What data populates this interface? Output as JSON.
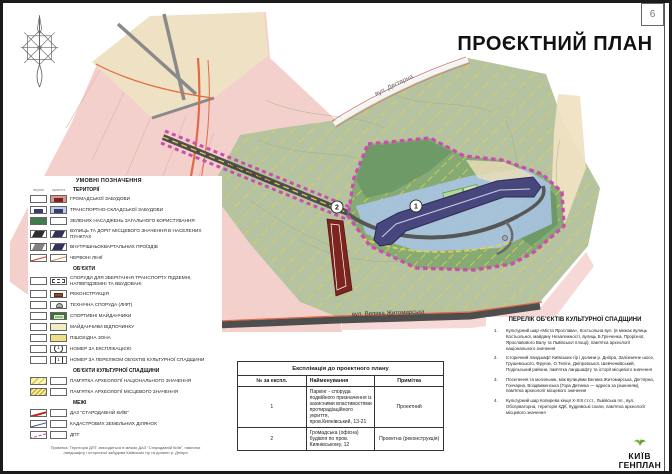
{
  "page": {
    "number": "6",
    "title": "ПРОЄКТНИЙ ПЛАН"
  },
  "map": {
    "street_labels": {
      "dehtiarna": "вул. Дегтярна",
      "kyianivskyi": "пров. Киянівський",
      "zhytomyrska": "вул. Велика Житомирська"
    },
    "markers": {
      "parking": "1",
      "office": "2"
    }
  },
  "legend": {
    "title": "УМОВНІ ПОЗНАЧЕННЯ",
    "columns": {
      "existing": "існуючі",
      "projected": "проектні"
    },
    "sections": [
      {
        "title": "ТЕРИТОРІЇ",
        "items": [
          {
            "label": "ГРОМАДСЬКОЇ ЗАБУДОВИ"
          },
          {
            "label": "ТРАНСПОРТНО-СКЛАДСЬКОЇ ЗАБУДОВИ"
          },
          {
            "label": "ЗЕЛЕНИХ НАСАДЖЕНЬ ЗАГАЛЬНОГО КОРИСТУВАННЯ"
          },
          {
            "label": "ВУЛИЦЬ ТА ДОРІГ МІСЦЕВОГО ЗНАЧЕННЯ В НАСЕЛЕНИХ ПУНКТАХ"
          },
          {
            "label": "ВНУТРІШНЬОКВАРТАЛЬНИХ ПРОЇЗДІВ"
          },
          {
            "label": "ЧЕРВОНІ ЛІНІЇ"
          }
        ]
      },
      {
        "title": "ОБ'ЄКТИ",
        "items": [
          {
            "label": "СПОРУДИ ДЛЯ ЗБЕРІГАННЯ ТРАНСПОРТУ ПІДЗЕМНІ, НАПІВПІДЗЕМНІ ТА ВБУДОВАНІ"
          },
          {
            "label": "РЕКОНСТРУКЦІЯ"
          },
          {
            "label": "ТЕХНІЧНА СПОРУДА (ЛІФТ)"
          },
          {
            "label": "СПОРТИВНІ МАЙДАНЧИКИ"
          },
          {
            "label": "МАЙДАНЧИКИ ВІДПОЧИНКУ"
          },
          {
            "label": "ПІШОХІДНА ЗОНА"
          },
          {
            "label": "НОМЕР ЗА ЕКСПЛІКАЦІЄЮ",
            "symbol": "1"
          },
          {
            "label": "НОМЕР ЗА ПЕРЕЛІКОМ ОБ'ЄКТІВ КУЛЬТУРНОЇ СПАДЩИНИ",
            "symbol": "1"
          }
        ]
      },
      {
        "title": "ОБ'ЄКТИ КУЛЬТУРНОЇ СПАДЩИНИ",
        "items": [
          {
            "label": "ПАМ'ЯТКА АРХЕОЛОГІЇ НАЦІОНАЛЬНОГО ЗНАЧЕННЯ"
          },
          {
            "label": "ПАМ'ЯТКА АРХЕОЛОГІЇ МІСЦЕВОГО ЗНАЧЕННЯ"
          }
        ]
      },
      {
        "title": "МЕЖІ",
        "items": [
          {
            "label": "ДАЗ \"СТАРОДАВНІЙ КИЇВ\""
          },
          {
            "label": "КАДАСТРОВИХ ЗЕМЕЛЬНИХ ДІЛЯНОК"
          },
          {
            "label": "ДПТ"
          }
        ]
      }
    ],
    "note": "Примітка: Територія ДПТ знаходиться в межах ДАЗ \"Стародавній Київ\", пам'ятки ландшафту і історичної забудови Київських гір та долини р. Дніпра"
  },
  "explication_table": {
    "title": "Експлікація до проектного плану",
    "headers": [
      "№ за експл.",
      "Найменування",
      "Примітка"
    ],
    "rows": [
      {
        "num": "1",
        "name": "Паркінг - споруда подвійного призначення із захисними властивостями протирадіаційного укриття, пров.Киянівський, 13-21",
        "note": "Проектний"
      },
      {
        "num": "2",
        "name": "Громадська (офісна) будівля по пров. Киянівському, 12",
        "note": "Проектна (реконструкція)"
      }
    ]
  },
  "heritage_list": {
    "title": "ПЕРЕЛІК ОБ'ЄКТІВ КУЛЬТУРНОЇ СПАДЩИНИ",
    "items": [
      {
        "num": "1.",
        "text": "Культурний шар «Міста Ярослава», Костьольна вул. (в межах вулиць Костьольної, майдану Незалежності, вулиць Б.Грінченка, Прорізної, Ярославового Валу та Львівської площі), пам'ятка археології національного значення"
      },
      {
        "num": "2.",
        "text": "Історичний ландшафт Київських гір і долини р. Дніпра, Залізничне шосе, Грушевського, Фрунзе, О.Теліги, Дніпровської, Шевченківський, Подільський райони, пам'ятка ландшафту та історії місцевого значення"
      },
      {
        "num": "3.",
        "text": "Поселення та могильник, між вулицями Велика Житомирська, Дегтярна, Гончарна, Воздвиженська (Гора Дитинка — адреса за рішенням), пам'ятка археології місцевого значення"
      },
      {
        "num": "4.",
        "text": "Культурний шар Копирева кінця X-XIII ст.ст., Львівська пл., вул. Обсерваторна, територія КДІЇ, Кудрявські схили, пам'ятка археології місцевого значення"
      }
    ]
  },
  "logo": {
    "line1": "КИЇВ",
    "line2": "ГЕНПЛАН"
  },
  "colors": {
    "public_area_pink": "#f4d0cc",
    "green_area": "#b6c3a1",
    "site_green": "#85aa74",
    "parking_navy": "#47477e",
    "reconstruction_red": "#7c241e",
    "boundary_magenta": "#c94fae",
    "red_line": "#e06a45",
    "road_gray": "#4e4e4e",
    "hatch_yellow": "#e3cf4a"
  }
}
